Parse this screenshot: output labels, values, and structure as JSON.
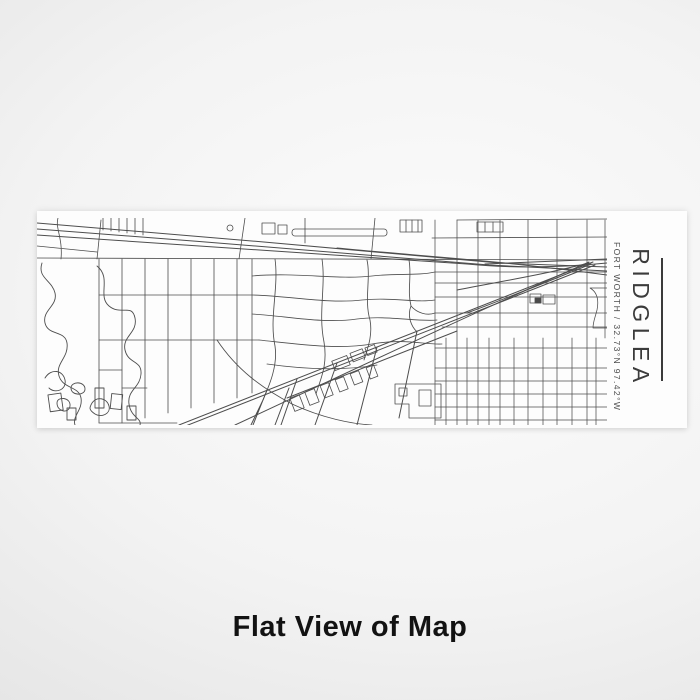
{
  "product_preview": {
    "map": {
      "title": "RIDGLEA",
      "subtitle": "FORT WORTH / 32.73°N 97.42°W",
      "style": "white",
      "line_color": "#4d4d4d",
      "background_color": "#fdfdfd"
    },
    "caption": "Flat View of Map",
    "colors": {
      "page_background_center": "#fcfcfc",
      "page_background_edge": "#d9d9d9",
      "caption_text": "#121212",
      "map_title_text": "#3b3b3b",
      "map_subtitle_text": "#4c4c4c"
    }
  }
}
